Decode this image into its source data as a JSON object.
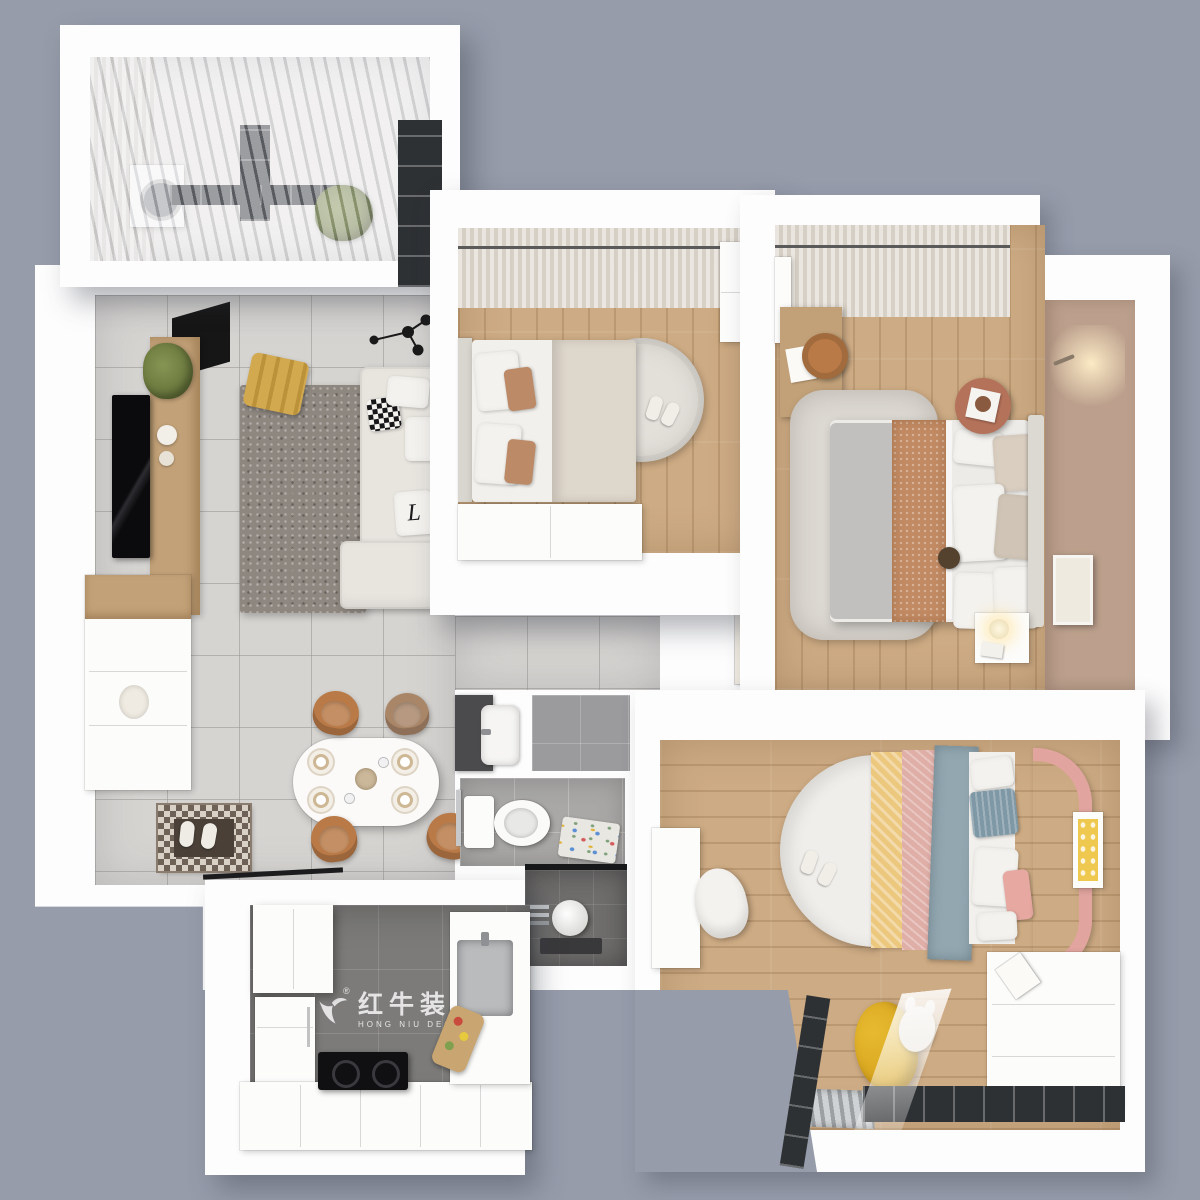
{
  "scene": {
    "type": "3d-floor-plan-render",
    "description": "Top-down 3D render of an apartment with living-dining room, kitchen, bathroom, balcony and three bedrooms",
    "background_color": "#969caa"
  },
  "watermark": {
    "brand_cn": "红牛装饰",
    "brand_en": "HONG NIU DECORATION",
    "registered_mark": "®"
  },
  "sofa_pillow_monogram": "L",
  "palette": {
    "bg": "#969caa",
    "wall": "#fdfdfd",
    "tile": "#d6d4d1",
    "wood": "#cdab84",
    "woodPanel": "#c2a178",
    "rugShag": "#8e8780",
    "rugLight": "#dcd8d2",
    "sofa": "#e8e5df",
    "accentYellow": "#d2a94f",
    "beanbag": "#d7a21b",
    "caramel": "#b97a47",
    "masterWall": "#bca08d",
    "rust": "#c18a63",
    "duvetGray": "#c1c0be",
    "kidsPink": "#e2a49f",
    "kidsYellow": "#ecc77e",
    "kidsBlue": "#93a7b1",
    "bathTile": "#a9a8a6",
    "showerDark": "#6f6e6c",
    "kitchenFloor": "#7c7b79",
    "frameDark": "#2e3134",
    "curtainLight": "#eeece8",
    "curtainDark": "#d7d3cc",
    "plantGreen": "#66743a"
  },
  "rooms": [
    {
      "id": "balcony",
      "label": "balcony"
    },
    {
      "id": "living-dining",
      "label": "living and dining room"
    },
    {
      "id": "kitchen",
      "label": "kitchen"
    },
    {
      "id": "bathroom",
      "label": "bathroom"
    },
    {
      "id": "hallway",
      "label": "hallway"
    },
    {
      "id": "bedroom-top",
      "label": "second bedroom"
    },
    {
      "id": "bedroom-master",
      "label": "master bedroom"
    },
    {
      "id": "bedroom-kids",
      "label": "kids bedroom"
    }
  ]
}
